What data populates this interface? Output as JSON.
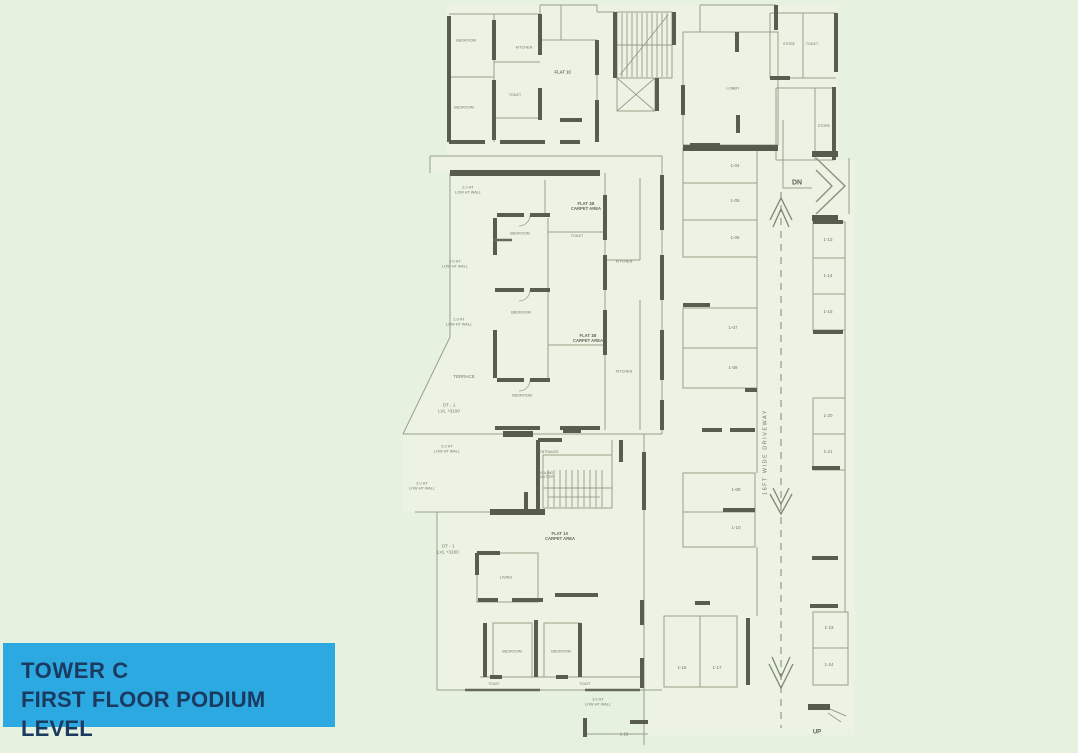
{
  "colors": {
    "background": "#e6f1df",
    "plan_interior": "#eff5e7",
    "wall_dark": "#585d4f",
    "line_olive": "#97a089",
    "annotation_text": "#6e7761",
    "title_box_bg": "#2ca9e1",
    "title_box_text": "#1b3a60"
  },
  "title_box": {
    "line1": "TOWER C",
    "line2": "FIRST FLOOR PODIUM LEVEL"
  },
  "plan": {
    "labels": [
      {
        "role": "marker-dn",
        "t": "DN",
        "x": 797,
        "y": 184,
        "s": 7
      },
      {
        "role": "marker-up",
        "t": "UP",
        "x": 817,
        "y": 733,
        "s": 6
      },
      {
        "role": "driveway-label",
        "t": "16FT WIDE DRIVEWAY",
        "x": 766,
        "y": 452,
        "s": 5.5,
        "r": -90,
        "sp": 1.5
      },
      {
        "role": "terrace-label",
        "t": "TERRACE",
        "x": 464,
        "y": 377,
        "s": 4.5
      },
      {
        "role": "terrace-label",
        "t": "OT - 1\nLVL +3100",
        "x": 449,
        "y": 408,
        "s": 4.5
      },
      {
        "role": "terrace-label",
        "t": "OT - 1\nLVL +3100",
        "x": 448,
        "y": 549,
        "s": 4.5
      },
      {
        "role": "wall-note",
        "t": "2.0 HT\nLOW HT WALL",
        "x": 468,
        "y": 190,
        "s": 3.8
      },
      {
        "role": "wall-note",
        "t": "2.0 HT\nLOW HT WALL",
        "x": 455,
        "y": 264,
        "s": 3.8
      },
      {
        "role": "wall-note",
        "t": "2.0 HT\nLOW HT WALL",
        "x": 459,
        "y": 322,
        "s": 3.8
      },
      {
        "role": "wall-note",
        "t": "2.0 HT\nLOW HT WALL",
        "x": 447,
        "y": 449,
        "s": 3.8
      },
      {
        "role": "wall-note",
        "t": "2.0 HT\nLOW HT WALL",
        "x": 422,
        "y": 486,
        "s": 3.8
      },
      {
        "role": "wall-note",
        "t": "3.5 HT\nLOW HT WALL",
        "x": 598,
        "y": 702,
        "s": 3.8
      },
      {
        "role": "flat-label",
        "t": "FLAT 1C",
        "x": 563,
        "y": 72,
        "s": 4.2,
        "cls": "flat"
      },
      {
        "role": "flat-label",
        "t": "FLAT 1B\nCARPET AREA",
        "x": 586,
        "y": 206,
        "s": 4.2,
        "cls": "flat"
      },
      {
        "role": "flat-label",
        "t": "FLAT 1B\nCARPET AREA",
        "x": 588,
        "y": 338,
        "s": 4.2,
        "cls": "flat"
      },
      {
        "role": "flat-label",
        "t": "FLAT 1A\nCARPET AREA",
        "x": 560,
        "y": 536,
        "s": 4.2,
        "cls": "flat"
      },
      {
        "role": "room-label",
        "t": "BEDROOM",
        "x": 466,
        "y": 41,
        "s": 3.8
      },
      {
        "role": "room-label",
        "t": "BEDROOM",
        "x": 464,
        "y": 108,
        "s": 3.8
      },
      {
        "role": "room-label",
        "t": "KITCHEN",
        "x": 524,
        "y": 48,
        "s": 3.8
      },
      {
        "role": "room-label",
        "t": "TOILET",
        "x": 515,
        "y": 95,
        "s": 3.5
      },
      {
        "role": "room-label",
        "t": "LOBBY",
        "x": 733,
        "y": 88,
        "s": 4
      },
      {
        "role": "room-label",
        "t": "STORE",
        "x": 789,
        "y": 44,
        "s": 3.5
      },
      {
        "role": "room-label",
        "t": "TOILET",
        "x": 812,
        "y": 44,
        "s": 3.5
      },
      {
        "role": "room-label",
        "t": "STORE",
        "x": 824,
        "y": 126,
        "s": 3.5
      },
      {
        "role": "room-label",
        "t": "BEDROOM",
        "x": 520,
        "y": 234,
        "s": 3.8
      },
      {
        "role": "room-label",
        "t": "BEDROOM",
        "x": 521,
        "y": 313,
        "s": 3.8
      },
      {
        "role": "room-label",
        "t": "TOILET",
        "x": 577,
        "y": 236,
        "s": 3.5
      },
      {
        "role": "room-label",
        "t": "KITCHEN",
        "x": 624,
        "y": 262,
        "s": 3.8
      },
      {
        "role": "room-label",
        "t": "BEDROOM",
        "x": 522,
        "y": 396,
        "s": 3.8
      },
      {
        "role": "room-label",
        "t": "KITCHEN",
        "x": 624,
        "y": 372,
        "s": 3.8
      },
      {
        "role": "room-label",
        "t": "ENTRANCE",
        "x": 549,
        "y": 452,
        "s": 3.5
      },
      {
        "role": "room-label",
        "t": "ROLLING\nSHUTTER",
        "x": 546,
        "y": 475,
        "s": 3.2
      },
      {
        "role": "room-label",
        "t": "LIVING",
        "x": 506,
        "y": 578,
        "s": 3.8
      },
      {
        "role": "room-label",
        "t": "BEDROOM",
        "x": 512,
        "y": 652,
        "s": 3.8
      },
      {
        "role": "room-label",
        "t": "BEDROOM",
        "x": 561,
        "y": 652,
        "s": 3.8
      },
      {
        "role": "room-label",
        "t": "TOILET",
        "x": 494,
        "y": 684,
        "s": 3.3
      },
      {
        "role": "room-label",
        "t": "TOILET",
        "x": 585,
        "y": 684,
        "s": 3.3
      },
      {
        "role": "parking-stall-number",
        "t": "1-04",
        "x": 735,
        "y": 166,
        "s": 4.5
      },
      {
        "role": "parking-stall-number",
        "t": "1-05",
        "x": 735,
        "y": 201,
        "s": 4.5
      },
      {
        "role": "parking-stall-number",
        "t": "1-06",
        "x": 735,
        "y": 238,
        "s": 4.5
      },
      {
        "role": "parking-stall-number",
        "t": "1-07",
        "x": 733,
        "y": 328,
        "s": 4.5
      },
      {
        "role": "parking-stall-number",
        "t": "1-08",
        "x": 733,
        "y": 368,
        "s": 4.5
      },
      {
        "role": "parking-stall-number",
        "t": "1-09",
        "x": 736,
        "y": 490,
        "s": 4.5
      },
      {
        "role": "parking-stall-number",
        "t": "1-10",
        "x": 736,
        "y": 528,
        "s": 4.5
      },
      {
        "role": "parking-stall-number",
        "t": "1-16",
        "x": 682,
        "y": 668,
        "s": 4.5
      },
      {
        "role": "parking-stall-number",
        "t": "1-17",
        "x": 717,
        "y": 668,
        "s": 4.5
      },
      {
        "role": "parking-stall-number",
        "t": "1-18",
        "x": 624,
        "y": 734,
        "s": 4.2
      },
      {
        "role": "parking-stall-number",
        "t": "1-13",
        "x": 828,
        "y": 240,
        "s": 4.5
      },
      {
        "role": "parking-stall-number",
        "t": "1-14",
        "x": 828,
        "y": 276,
        "s": 4.5
      },
      {
        "role": "parking-stall-number",
        "t": "1-15",
        "x": 828,
        "y": 312,
        "s": 4.5
      },
      {
        "role": "parking-stall-number",
        "t": "1-20",
        "x": 828,
        "y": 416,
        "s": 4.5
      },
      {
        "role": "parking-stall-number",
        "t": "1-21",
        "x": 828,
        "y": 452,
        "s": 4.5
      },
      {
        "role": "parking-stall-number",
        "t": "1-23",
        "x": 829,
        "y": 628,
        "s": 4.5
      },
      {
        "role": "parking-stall-number",
        "t": "1-24",
        "x": 829,
        "y": 665,
        "s": 4.5
      }
    ]
  }
}
